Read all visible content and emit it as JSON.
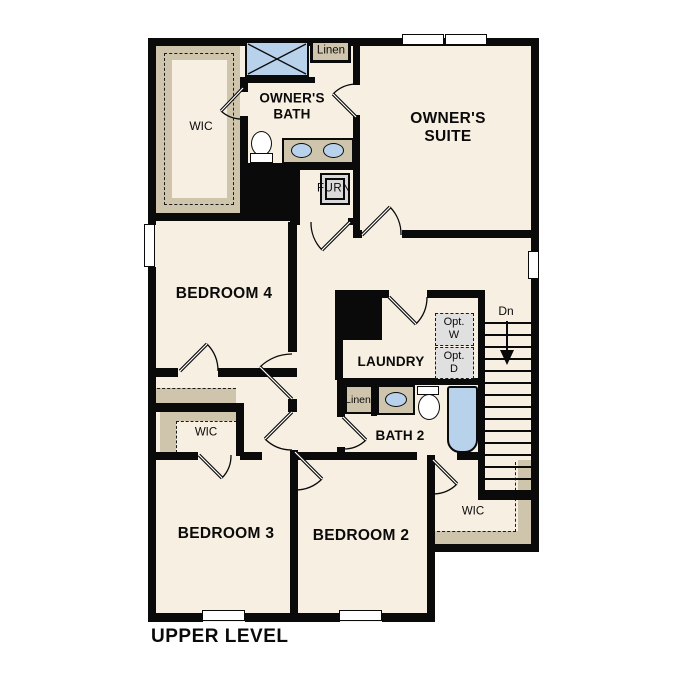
{
  "plan": {
    "title": "UPPER LEVEL",
    "rooms": {
      "owners_suite": "OWNER'S\nSUITE",
      "owners_bath": "OWNER'S\nBATH",
      "owners_wic": "WIC",
      "bedroom4": "BEDROOM 4",
      "bedroom3": "BEDROOM 3",
      "bedroom2": "BEDROOM 2",
      "laundry": "LAUNDRY",
      "bath2": "BATH 2",
      "bedroom3_wic": "WIC",
      "bedroom2_wic": "WIC"
    },
    "closets": {
      "owners_linen": "Linen",
      "bath2_linen": "Linen",
      "furnace": "FURN"
    },
    "stairs": {
      "direction": "Dn"
    },
    "options": {
      "washer": "Opt.\nW",
      "dryer": "Opt.\nD"
    },
    "colors": {
      "floor": "#f7efe2",
      "wall": "#0a0a0a",
      "shelving": "#cfc5ad",
      "fixture_blue": "#b7d2ea",
      "appliance_gray": "#e0e0e0"
    }
  }
}
